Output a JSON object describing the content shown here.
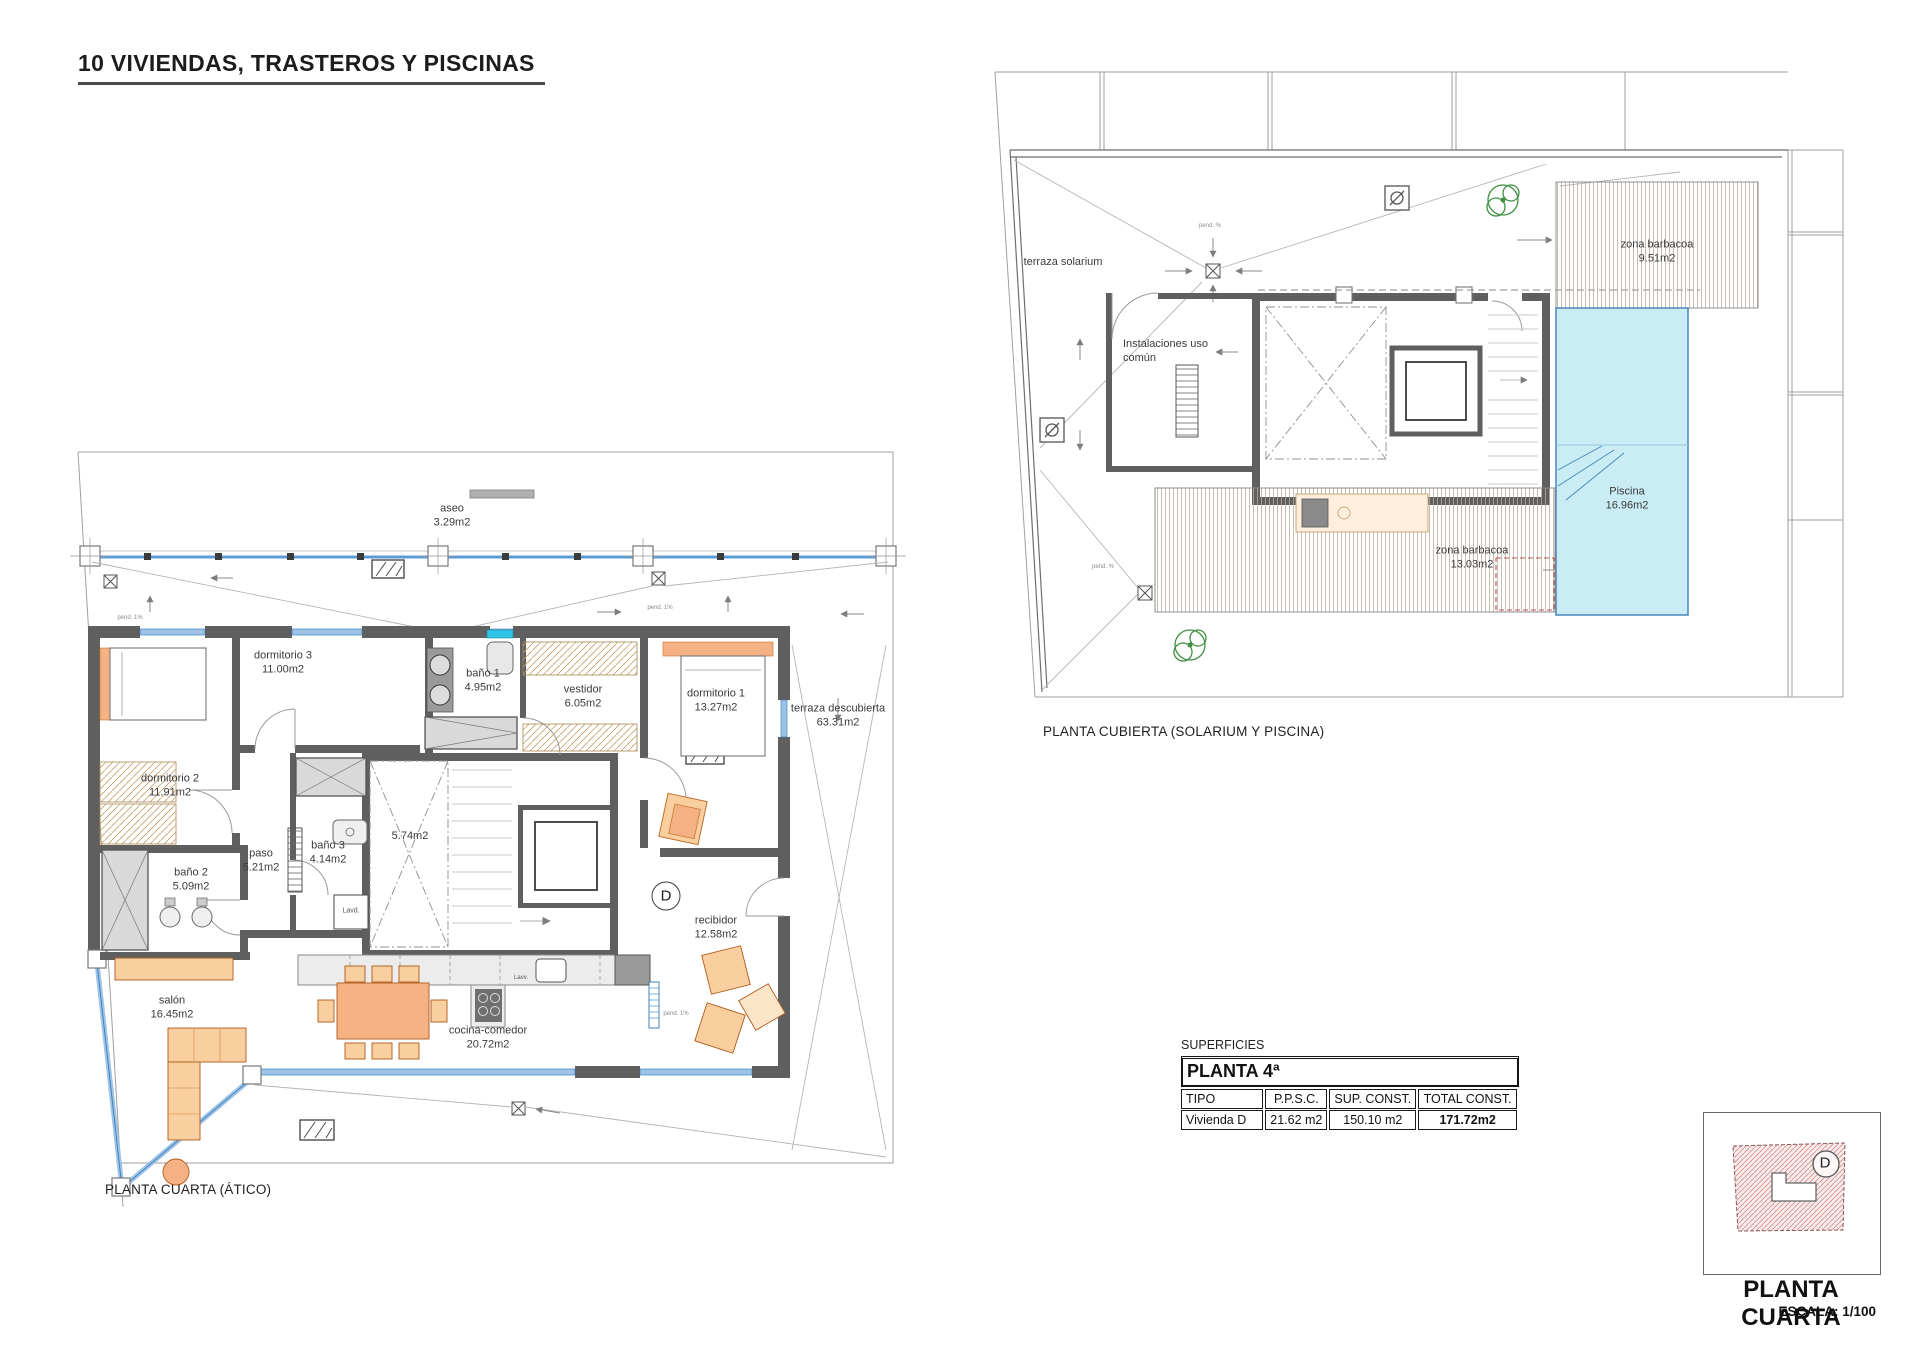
{
  "page": {
    "title": "10 VIVIENDAS, TRASTEROS Y PISCINAS"
  },
  "plan_atico": {
    "caption": "PLANTA CUARTA (ÁTICO)",
    "unit": "D",
    "pend_label": "pend. 1%",
    "appliances": {
      "lavd": "Lavd.",
      "lavv": "Lavv."
    },
    "rooms": [
      {
        "name": "aseo",
        "area": "3.29m2"
      },
      {
        "name": "dormitorio 3",
        "area": "11.00m2"
      },
      {
        "name": "baño 1",
        "area": "4.95m2"
      },
      {
        "name": "vestidor",
        "area": "6.05m2"
      },
      {
        "name": "dormitorio 1",
        "area": "13.27m2"
      },
      {
        "name": "terraza descubierta",
        "area": "63.31m2"
      },
      {
        "name": "dormitorio 2",
        "area": "11.91m2"
      },
      {
        "name": "paso",
        "area": "5.21m2"
      },
      {
        "name": "baño 3",
        "area": "4.14m2"
      },
      {
        "name": "baño 2",
        "area": "5.09m2"
      },
      {
        "name": "",
        "area": "5.74m2"
      },
      {
        "name": "recibidor",
        "area": "12.58m2"
      },
      {
        "name": "salón",
        "area": "16.45m2"
      },
      {
        "name": "cocina-comedor",
        "area": "20.72m2"
      }
    ]
  },
  "plan_cubierta": {
    "caption": "PLANTA CUBIERTA (SOLARIUM Y PISCINA)",
    "pend_label": "pend. %",
    "rooms": [
      {
        "name": "terraza solarium",
        "area": ""
      },
      {
        "name": "Instalaciones uso común",
        "area": ""
      },
      {
        "name": "zona barbacoa",
        "area": "9.51m2"
      },
      {
        "name": "Piscina",
        "area": "16.96m2"
      },
      {
        "name": "zona barbacoa",
        "area": "13.03m2"
      }
    ]
  },
  "surfaces_table": {
    "section_label": "SUPERFICIES",
    "floor_header": "PLANTA 4ª",
    "columns": [
      "TIPO",
      "P.P.S.C.",
      "SUP. CONST.",
      "TOTAL CONST."
    ],
    "rows": [
      [
        "Vivienda D",
        "21.62 m2",
        "150.10 m2",
        "171.72m2"
      ]
    ]
  },
  "legend": {
    "unit": "D",
    "title": "PLANTA CUARTA",
    "scale": "ESCALA: 1/100"
  },
  "colors": {
    "wall": "#5f5f5f",
    "glazing": "#9dc3e6",
    "glazing_frame": "#2e75b6",
    "pool": "#c9ecf5",
    "furniture_orange": "#f4b183",
    "furniture_light": "#f9cf9f",
    "deck_line": "#b9ab9c",
    "wardrobe_hatch": "#c8a06a",
    "plant_green": "#3f9142",
    "boundary": "#9f9f9f",
    "legend_hatch": "#d98f8f"
  }
}
